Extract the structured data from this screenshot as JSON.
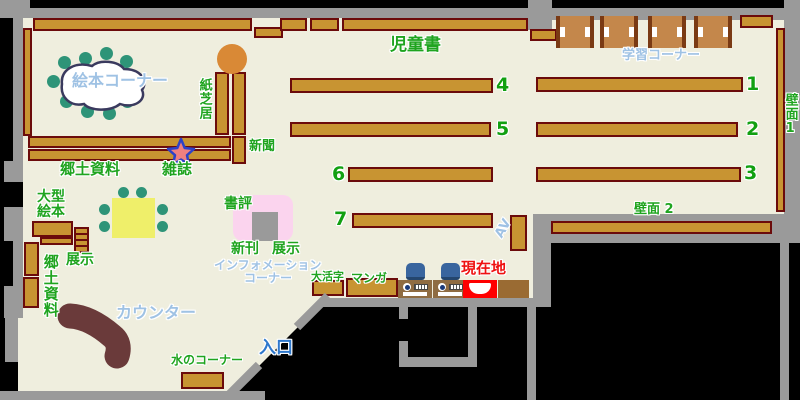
{
  "map_type": "library-floor-map",
  "labels": {
    "jidosho": "児童書",
    "gakushu_corner": "学習コーナー",
    "ehon_corner": "絵本コーナー",
    "kamishibai": "紙芝居",
    "shinbun": "新聞",
    "zasshi": "雑誌",
    "kyodo_shiryo_top": "郷土資料",
    "ogata_ehon_line1": "大型",
    "ogata_ehon_line2": "絵本",
    "tenji_left": "展示",
    "kyodo_shiryo_left": "郷土資料",
    "hekimen_1": "壁面1",
    "hekimen_2": "壁面 2",
    "shohyo": "書評",
    "shinkan": "新刊",
    "tenji_center": "展示",
    "information_line1": "インフォメーション",
    "information_line2": "コーナー",
    "daikatsuji": "大活字",
    "manga": "マンガ",
    "genzaichi": "現在地",
    "av": "AV",
    "counter": "カウンター",
    "mizu_corner": "水のコーナー",
    "iriguchi": "入口"
  },
  "shelf_numbers": [
    "1",
    "2",
    "3",
    "4",
    "5",
    "6",
    "7"
  ],
  "colors": {
    "floor": "#EFEEDE",
    "outside": "#000000",
    "wall": "#9A9A9A",
    "shelf_fill": "#C89432",
    "shelf_border": "#6B0B0B",
    "desk_wood": "#C4874B",
    "label_green": "#1FA41F",
    "label_light_blue": "#9FC2E4",
    "entrance_blue": "#2E78CC",
    "current_location_red": "#FF0000",
    "table_yellow": "#EFEF6A",
    "chair_teal": "#2E9478",
    "round_table_orange": "#D98936",
    "display_pink": "#FBD4EE",
    "display_gray": "#9A9A9A",
    "counter_brown": "#6A3A3A",
    "screen_blue": "#39659E",
    "star_fill": "#EE8080",
    "star_border": "#2C42C8"
  }
}
